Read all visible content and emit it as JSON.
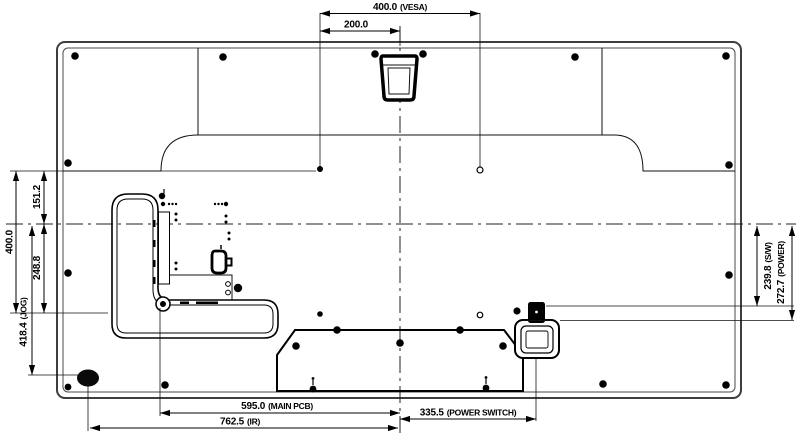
{
  "drawing": {
    "title": "display-rear-view-dimensions",
    "dims": {
      "vesa_w": {
        "value": "400.0",
        "suffix": "(VESA)"
      },
      "vesa_half": {
        "value": "200.0",
        "suffix": ""
      },
      "left_upper": {
        "value": "151.2",
        "suffix": ""
      },
      "left_vesa_h": {
        "value": "400.0",
        "suffix": ""
      },
      "left_lower": {
        "value": "248.8",
        "suffix": ""
      },
      "jog": {
        "value": "418.4",
        "suffix": "(JOG)"
      },
      "sw": {
        "value": "239.8",
        "suffix": "(S/W)"
      },
      "power": {
        "value": "272.7",
        "suffix": "(POWER)"
      },
      "main_pcb": {
        "value": "595.0",
        "suffix": "(MAIN PCB)"
      },
      "power_switch": {
        "value": "335.5",
        "suffix": "(POWER SWITCH)"
      },
      "ir": {
        "value": "762.5",
        "suffix": "(IR)"
      }
    },
    "colors": {
      "line": "#111111",
      "background": "#ffffff"
    }
  }
}
